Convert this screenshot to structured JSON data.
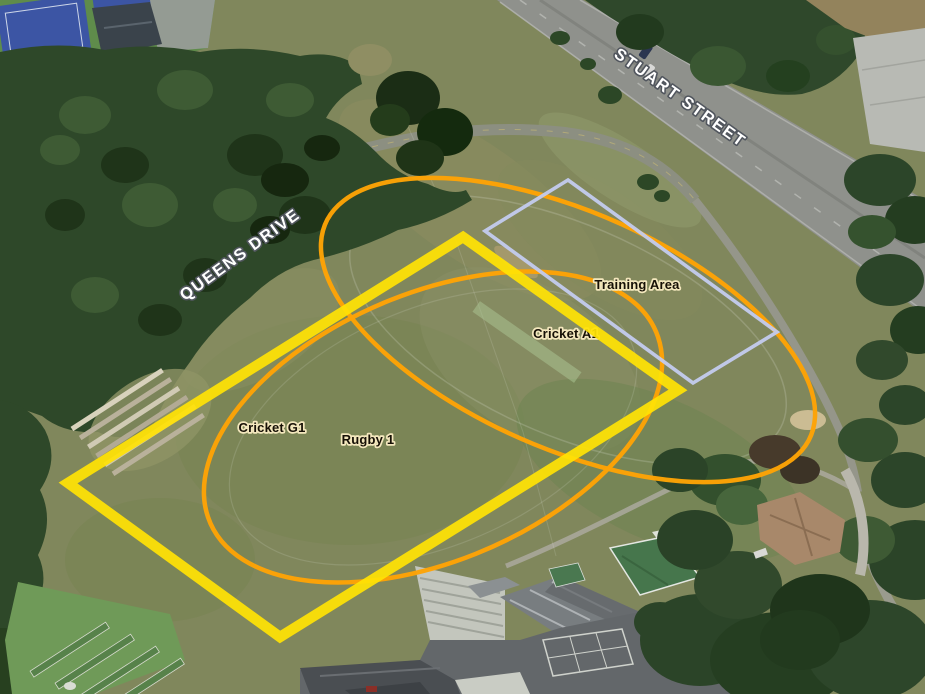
{
  "map": {
    "title": "Sports ground aerial booking map",
    "street_labels": [
      {
        "id": "stuart-street",
        "text": "STUART STREET",
        "transform": "translate(677,102) rotate(35.5)"
      },
      {
        "id": "queens-drive",
        "text": "QUEENS DRIVE",
        "transform": "translate(243,259) rotate(-36)"
      }
    ],
    "field_labels": [
      {
        "id": "training-area",
        "text": "Training Area",
        "transform": "translate(637,289)"
      },
      {
        "id": "cricket-a1",
        "text": "Cricket A1",
        "transform": "translate(566,338)"
      },
      {
        "id": "cricket-g1",
        "text": "Cricket G1",
        "transform": "translate(272,432)"
      },
      {
        "id": "rugby-1",
        "text": "Rugby 1",
        "transform": "translate(368,444)"
      }
    ],
    "overlays": {
      "rugby_pitch": {
        "label": "Rugby 1",
        "shape": "rectangle",
        "color": "#ffe205",
        "points": "463,237 678,390 280,637 68,483"
      },
      "training_area": {
        "label": "Training Area",
        "shape": "rectangle",
        "color": "#c3cbee",
        "points": "568,180 777,332 693,383 485,231"
      },
      "cricket_a1": {
        "label": "Cricket A1",
        "shape": "oval",
        "color": "#ffa405",
        "transform": "matrix(232,35,85,148,568,330)"
      },
      "cricket_g1": {
        "label": "Cricket G1",
        "shape": "oval",
        "color": "#ffa405",
        "transform": "matrix(225,-37,-43,151,433,427)"
      }
    },
    "colors": {
      "rugby_outline": "#ffe205",
      "cricket_outline": "#ffa405",
      "training_outline": "#c3cbee",
      "label_text": "#161006",
      "label_halo": "#f3e7bd",
      "street_text": "#ffffff"
    }
  }
}
